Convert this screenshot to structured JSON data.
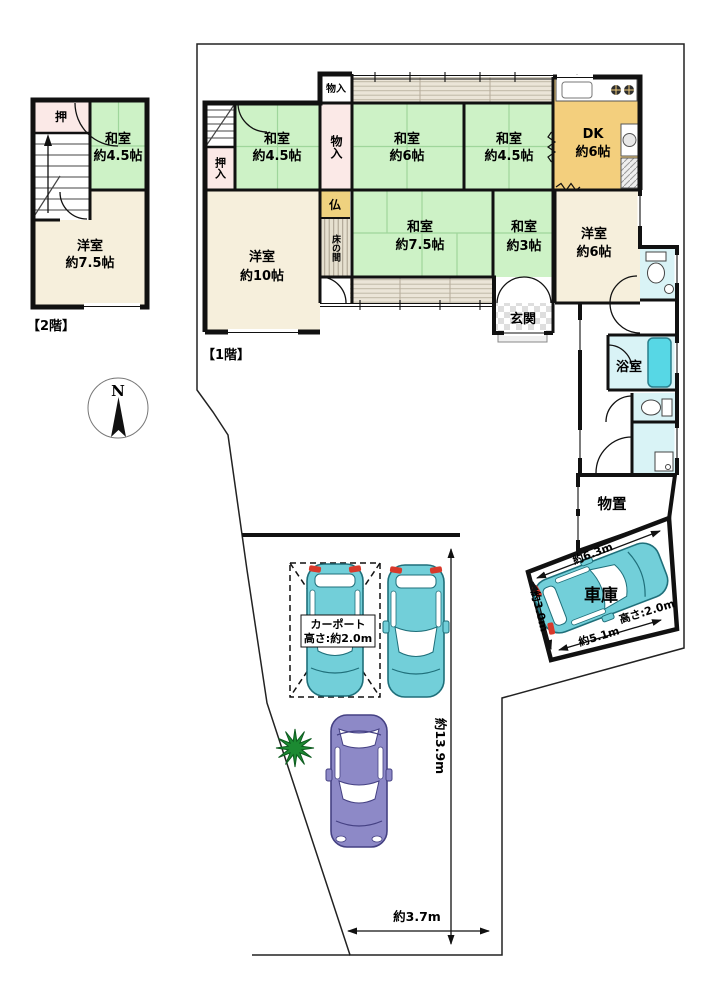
{
  "colors": {
    "wall": "#111111",
    "tatami_green": "#cdf2c6",
    "wood_beige": "#f6efdc",
    "closet_pink": "#fbe9e7",
    "dk_tan": "#f3cf7d",
    "butsuma_tan": "#efd27f",
    "water_cyan": "#d9f3f6",
    "tub_cyan": "#57d7e5",
    "car_teal": "#72cfd9",
    "car_purple": "#8d89c7",
    "tree_green": "#1c8a32"
  },
  "floor2": {
    "caption": "【2階】",
    "oshi": "押",
    "washitsu": {
      "name": "和室",
      "size": "約4.5帖"
    },
    "youshitsu": {
      "name": "洋室",
      "size": "約7.5帖"
    }
  },
  "floor1": {
    "caption": "【1階】",
    "oshiire": "押入",
    "monoire_small": "物入",
    "monoire": "物入",
    "washitsu_45a": {
      "name": "和室",
      "size": "約4.5帖"
    },
    "washitsu_6": {
      "name": "和室",
      "size": "約6帖"
    },
    "washitsu_45b": {
      "name": "和室",
      "size": "約4.5帖"
    },
    "dk": {
      "name": "DK",
      "size": "約6帖"
    },
    "butsuma": "仏",
    "tokonoma": "床の間",
    "washitsu_75": {
      "name": "和室",
      "size": "約7.5帖"
    },
    "washitsu_3": {
      "name": "和室",
      "size": "約3帖"
    },
    "youshitsu_10": {
      "name": "洋室",
      "size": "約10帖"
    },
    "youshitsu_6": {
      "name": "洋室",
      "size": "約6帖"
    },
    "genkan": "玄関",
    "yokushitsu": "浴室"
  },
  "site": {
    "north": "N",
    "monooki": "物置",
    "shako": "車庫",
    "garage_width": "約6.3m",
    "garage_depth": "約3.0m",
    "garage_length": "約5.1m",
    "garage_height": "高さ:2.0m",
    "carport_line1": "カーポート",
    "carport_line2": "高さ:約2.0m",
    "depth_total": "約13.9m",
    "front_width": "約3.7m"
  }
}
